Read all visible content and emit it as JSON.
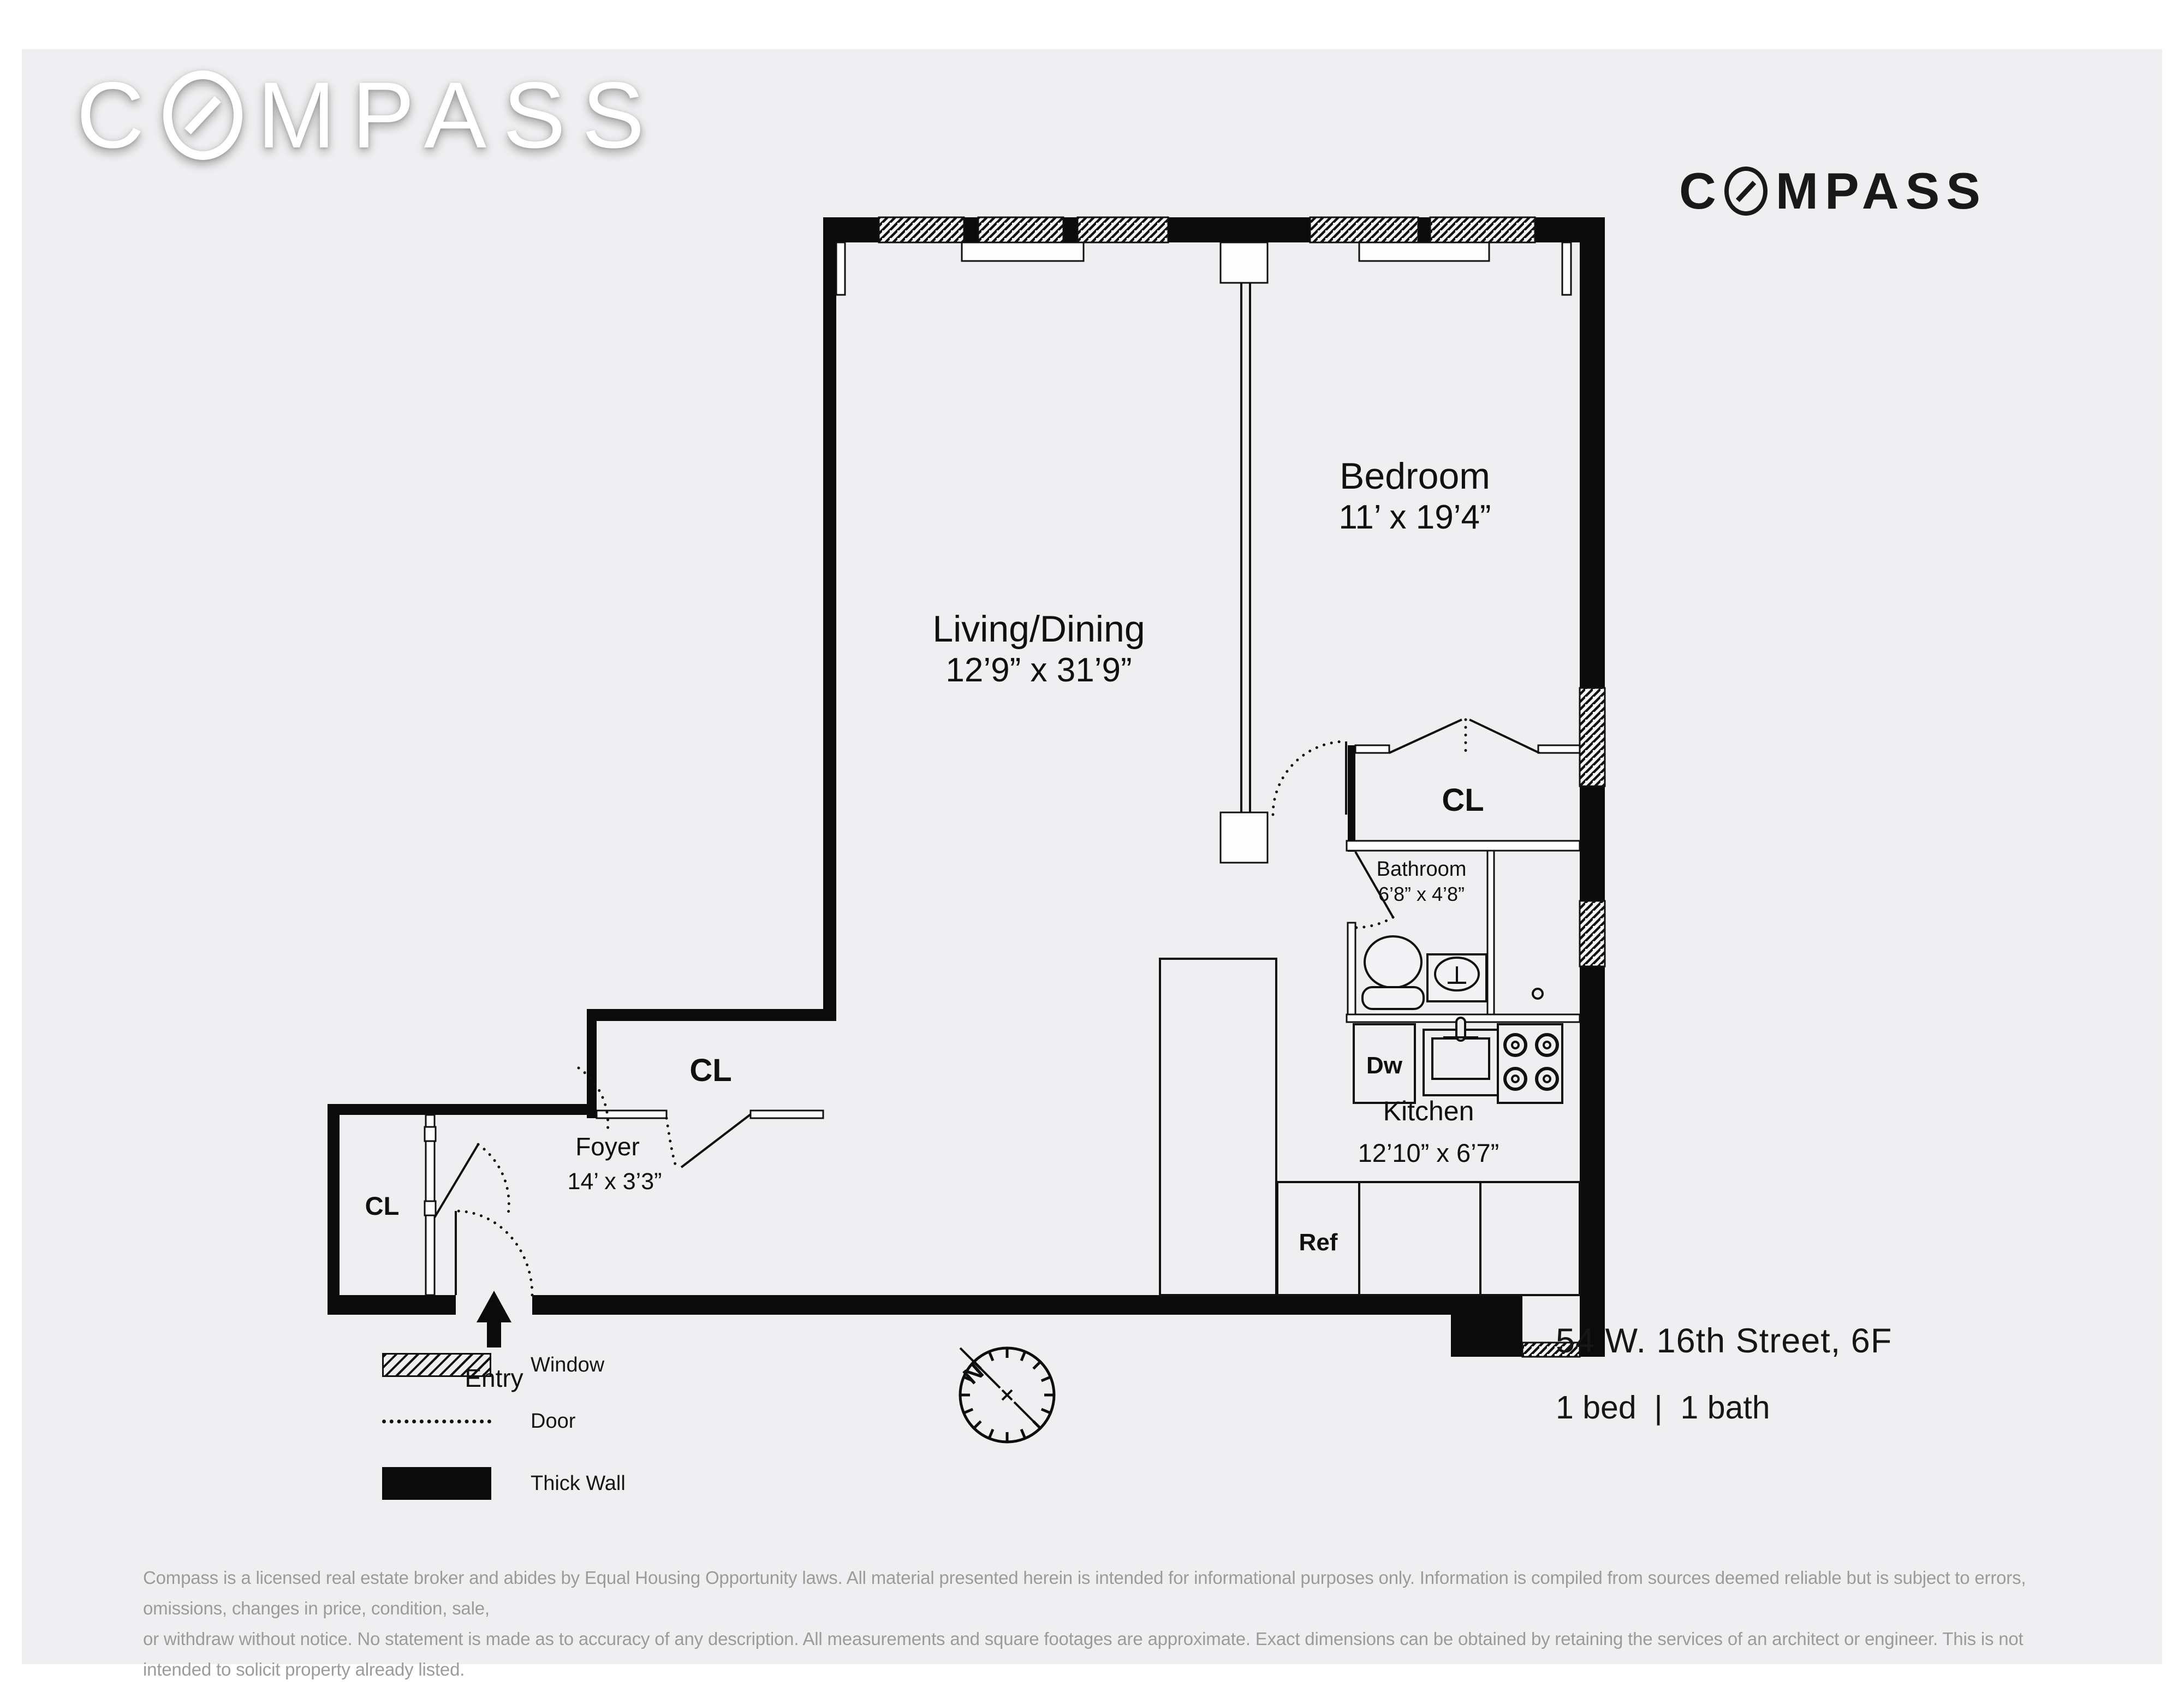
{
  "brand": {
    "pre": "C",
    "post": "MPASS"
  },
  "listing": {
    "address": "54 W. 16th Street, 6F",
    "beds_baths": "1 bed  |  1 bath"
  },
  "rooms": {
    "living": {
      "name": "Living/Dining",
      "dims": "12’9” x 31’9”"
    },
    "bedroom": {
      "name": "Bedroom",
      "dims": "11’ x 19’4”"
    },
    "bathroom": {
      "name": "Bathroom",
      "dims": "6’8” x 4’8”"
    },
    "kitchen": {
      "name": "Kitchen",
      "dims": "12’10” x 6’7”"
    },
    "foyer": {
      "name": "Foyer",
      "dims": "14’ x 3’3”"
    }
  },
  "labels": {
    "closet": "CL",
    "dishwasher": "Dw",
    "refrigerator": "Ref",
    "entry": "Entry",
    "north": "N"
  },
  "legend": {
    "window": "Window",
    "door": "Door",
    "thick_wall": "Thick Wall"
  },
  "disclaimer": {
    "line1": "Compass is a licensed real estate broker and abides by Equal Housing Opportunity laws. All material presented herein is intended for informational purposes only. Information is compiled from sources deemed reliable but is subject to errors, omissions, changes in price, condition, sale,",
    "line2": "or withdraw without notice. No statement is made as to accuracy of any description. All measurements and square footages are approximate. Exact dimensions can be obtained by retaining the services of an architect or engineer. This is not intended to solicit property already listed."
  },
  "colors": {
    "panel": "#efeef0",
    "ink": "#0b0b0b",
    "muted": "#9b9b9b"
  }
}
